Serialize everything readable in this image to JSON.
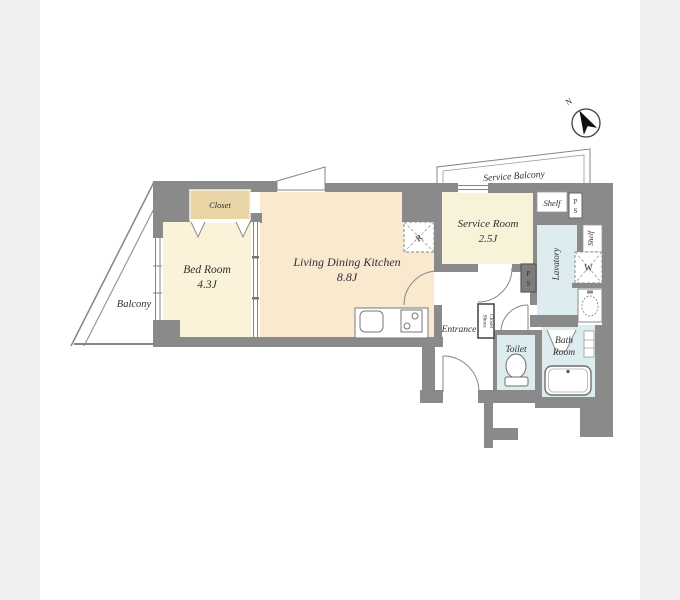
{
  "title": "apartment floor plan",
  "compass": {
    "north_label": "N"
  },
  "rooms": {
    "balcony": {
      "label": "Balcony"
    },
    "bedroom": {
      "name": "Bed Room",
      "size": "4.3J"
    },
    "closet": {
      "label": "Closet"
    },
    "ldk": {
      "name": "Living Dining Kitchen",
      "size": "8.8J"
    },
    "service_room": {
      "name": "Service Room",
      "size": "2.5J"
    },
    "service_balcony": {
      "label": "Service Balcony"
    },
    "shelf_top": {
      "label": "Shelf"
    },
    "shelf_side": {
      "label": "Shelf"
    },
    "lavatory": {
      "label": "Lavatory"
    },
    "entrance": {
      "label": "Entrance"
    },
    "shoes_closet": {
      "line1": "Shoes",
      "line2": "Closet"
    },
    "toilet": {
      "label": "Toilet"
    },
    "bathroom": {
      "line1": "Bath",
      "line2": "Room"
    }
  },
  "fixtures": {
    "washer": {
      "label": "W"
    },
    "refrigerator": {
      "label": "R"
    },
    "pipe_space_top": {
      "p": "P",
      "s": "S"
    },
    "pipe_space_hall": {
      "p": "P",
      "s": "S"
    }
  },
  "colors": {
    "wall": "#8a8a8a",
    "bedroom_floor": "#faf3d9",
    "ldk_floor": "#f8e9cf",
    "service_room_floor": "#f8f3d8",
    "closet_fill": "#e9d4a6",
    "wet_area": "#dcecef",
    "photo_edge": "#efefef",
    "sheet": "#ffffff",
    "line": "#858585"
  }
}
